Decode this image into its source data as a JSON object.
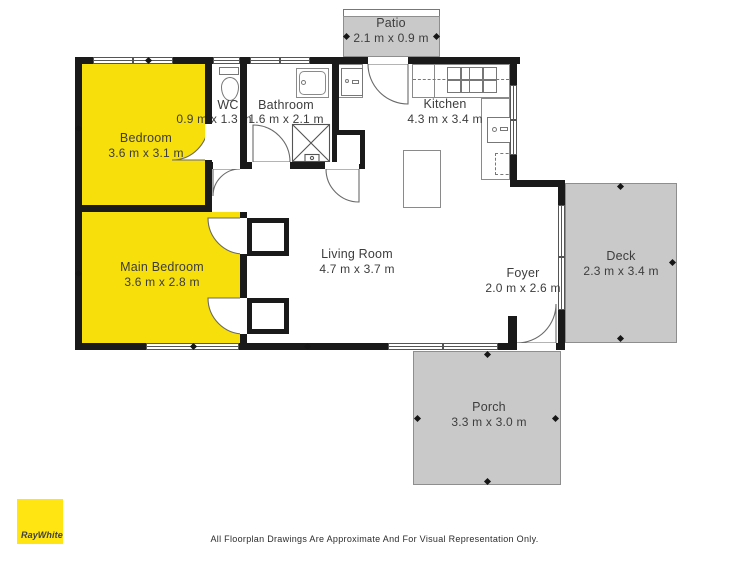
{
  "colors": {
    "highlight": "#F6DF0B",
    "brand_yellow": "#FFE512",
    "outdoor": "#C9C9C9",
    "wall": "#1A1A1A"
  },
  "rooms": {
    "patio": {
      "name": "Patio",
      "dims": "2.1 m x 0.9 m"
    },
    "bedroom": {
      "name": "Bedroom",
      "dims": "3.6 m x 3.1 m"
    },
    "wc": {
      "name": "WC",
      "dims": "0.9 m x 1.3 m"
    },
    "bathroom": {
      "name": "Bathroom",
      "dims": "1.6 m x 2.1 m"
    },
    "kitchen": {
      "name": "Kitchen",
      "dims": "4.3 m x 3.4 m"
    },
    "living_room": {
      "name": "Living Room",
      "dims": "4.7 m x 3.7 m"
    },
    "main_bedroom": {
      "name": "Main Bedroom",
      "dims": "3.6 m x 2.8 m"
    },
    "foyer": {
      "name": "Foyer",
      "dims": "2.0 m x 2.6 m"
    },
    "deck": {
      "name": "Deck",
      "dims": "2.3 m x 3.4 m"
    },
    "porch": {
      "name": "Porch",
      "dims": "3.3 m x 3.0 m"
    }
  },
  "brand": {
    "name": "RayWhite"
  },
  "footer": {
    "disclaimer": "All Floorplan Drawings Are Approximate And For Visual Representation Only."
  }
}
